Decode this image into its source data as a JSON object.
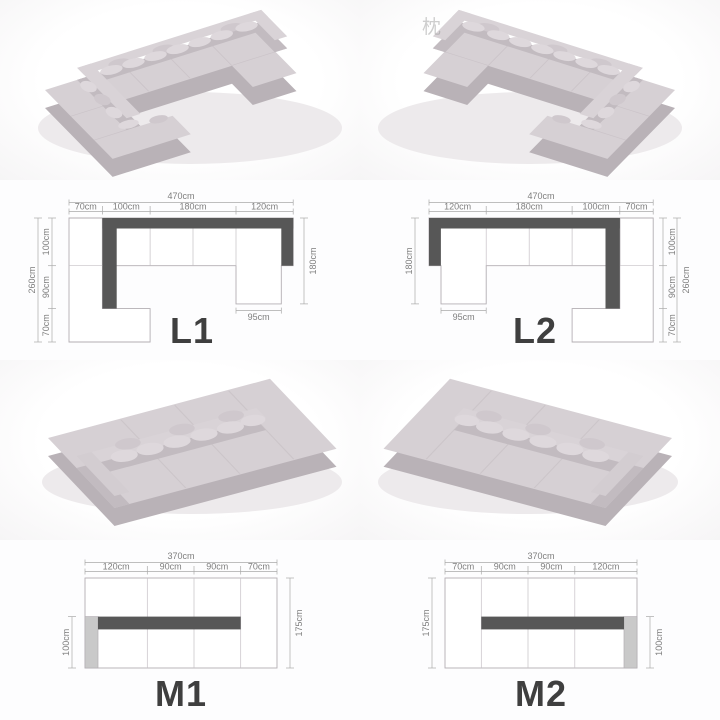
{
  "watermark": {
    "text": "枕"
  },
  "diagrams": {
    "L1": {
      "label": "L1",
      "total_width": "470cm",
      "top_segments": [
        "70cm",
        "100cm",
        "180cm",
        "120cm"
      ],
      "side_total": "260cm",
      "side_segments": [
        "100cm",
        "90cm",
        "70cm"
      ],
      "opposite_height": "180cm",
      "chaise_width": "95cm"
    },
    "L2": {
      "label": "L2",
      "total_width": "470cm",
      "top_segments": [
        "120cm",
        "180cm",
        "100cm",
        "70cm"
      ],
      "side_total": "260cm",
      "side_segments": [
        "100cm",
        "90cm",
        "70cm"
      ],
      "opposite_height": "180cm",
      "chaise_width": "95cm"
    },
    "M1": {
      "label": "M1",
      "total_width": "370cm",
      "top_segments": [
        "120cm",
        "90cm",
        "90cm",
        "70cm"
      ],
      "side_height": "175cm",
      "seat_depth": "100cm"
    },
    "M2": {
      "label": "M2",
      "total_width": "370cm",
      "top_segments": [
        "70cm",
        "90cm",
        "90cm",
        "120cm"
      ],
      "side_height": "175cm",
      "seat_depth": "100cm"
    }
  },
  "colors": {
    "backrest_dark": "#575757",
    "armrest_gray": "#c9c9c9",
    "outline_gray": "#b3aeb3",
    "dim_text_gray": "#7e7e7e",
    "label_dark": "#3f3f3f",
    "sofa_fabric": "#d6d0d4",
    "background": "#fcfcfd"
  }
}
